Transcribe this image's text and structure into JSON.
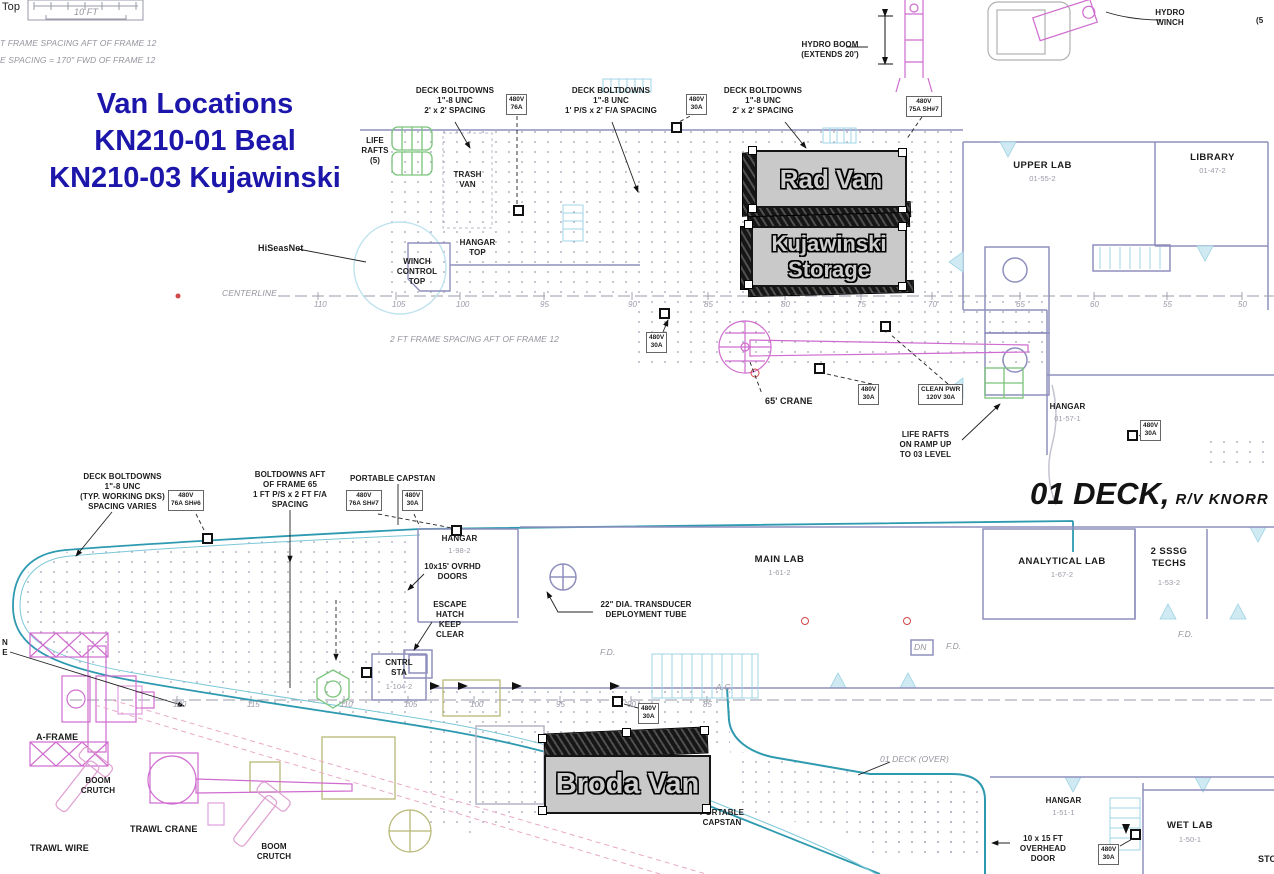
{
  "title": {
    "lines": [
      "Van Locations",
      "KN210-01 Beal",
      "KN210-03 Kujawinski"
    ],
    "color": "#1c16aa"
  },
  "deck_title": {
    "main": "01 DECK,",
    "sub": "R/V KNORR"
  },
  "vans": {
    "rad": "Rad Van",
    "kujawinski": "Kujawinski\nStorage",
    "broda": "Broda Van"
  },
  "colors": {
    "title_blue": "#1c16aa",
    "wall_slate": "#8f8fbe",
    "hull_teal": "#2e9ab0",
    "crane_magenta": "#cf6ccf",
    "raft_green": "#7ac47a",
    "van_gray": "#c9c9c9"
  },
  "annotations": [
    {
      "t": "Top",
      "x": 2,
      "y": 1,
      "c": "med",
      "n": "corner-label-top"
    },
    {
      "t": "10 FT",
      "x": 56,
      "y": 7,
      "w": 60,
      "c": "ic",
      "n": "scale-bar-label"
    },
    {
      "t": "T FRAME SPACING AFT OF FRAME 12",
      "x": 0,
      "y": 38,
      "c": "i",
      "n": "frame-spacing-note-1"
    },
    {
      "t": "E SPACING = 170\" FWD OF FRAME 12",
      "x": 0,
      "y": 55,
      "c": "i",
      "n": "frame-spacing-note-2"
    },
    {
      "t": "DECK BOLTDOWNS\n1\"-8 UNC\n2' x 2' SPACING",
      "x": 405,
      "y": 86,
      "w": 100,
      "c": "c",
      "n": "label-deck-boltdowns-a"
    },
    {
      "t": "DECK BOLTDOWNS\n1\"-8 UNC\n1' P/S x 2' F/A SPACING",
      "x": 550,
      "y": 86,
      "w": 122,
      "c": "c",
      "n": "label-deck-boltdowns-b"
    },
    {
      "t": "DECK BOLTDOWNS\n1\"-8 UNC\n2' x 2' SPACING",
      "x": 713,
      "y": 86,
      "w": 100,
      "c": "c",
      "n": "label-deck-boltdowns-c"
    },
    {
      "t": "HYDRO BOOM\n(EXTENDS 20')",
      "x": 790,
      "y": 40,
      "w": 80,
      "c": "c",
      "n": "label-hydro-boom"
    },
    {
      "t": "HYDRO\nWINCH",
      "x": 1145,
      "y": 8,
      "w": 50,
      "c": "c",
      "n": "label-hydro-winch"
    },
    {
      "t": "(5",
      "x": 1256,
      "y": 16,
      "n": "cut-label-right"
    },
    {
      "t": "LIFE\nRAFTS\n(5)",
      "x": 355,
      "y": 136,
      "w": 40,
      "c": "c",
      "n": "label-life-rafts"
    },
    {
      "t": "TRASH\nVAN",
      "x": 445,
      "y": 170,
      "w": 45,
      "c": "c",
      "n": "label-trash-van"
    },
    {
      "t": "HANGAR\nTOP",
      "x": 450,
      "y": 238,
      "w": 55,
      "c": "c",
      "n": "label-hangar-top"
    },
    {
      "t": "WINCH\nCONTROL\nTOP",
      "x": 392,
      "y": 257,
      "w": 50,
      "c": "c",
      "n": "label-winch-control-top"
    },
    {
      "t": "HiSeasNet",
      "x": 258,
      "y": 243,
      "c": "bold",
      "n": "label-hiseasnet"
    },
    {
      "t": "CENTERLINE",
      "x": 222,
      "y": 288,
      "c": "i",
      "n": "label-centerline"
    },
    {
      "t": "2 FT FRAME SPACING AFT OF FRAME 12",
      "x": 390,
      "y": 334,
      "c": "i",
      "n": "label-frame-spacing-upper"
    },
    {
      "t": "65' CRANE",
      "x": 765,
      "y": 396,
      "c": "bold",
      "n": "label-65ft-crane"
    },
    {
      "t": "LIFE RAFTS\nON RAMP UP\nTO 03 LEVEL",
      "x": 888,
      "y": 430,
      "w": 75,
      "c": "c",
      "n": "label-life-rafts-ramp"
    },
    {
      "t": "HANGAR",
      "x": 1040,
      "y": 402,
      "w": 55,
      "c": "c",
      "n": "label-hangar-0157"
    },
    {
      "t": "01-57-1",
      "x": 1040,
      "y": 414,
      "w": 55,
      "c": "csub"
    },
    {
      "t": "UPPER LAB",
      "x": 1005,
      "y": 160,
      "w": 75,
      "c": "cb",
      "n": "label-upper-lab"
    },
    {
      "t": "01-55-2",
      "x": 1005,
      "y": 174,
      "w": 75,
      "c": "csub"
    },
    {
      "t": "LIBRARY",
      "x": 1185,
      "y": 152,
      "w": 55,
      "c": "cb",
      "n": "label-library"
    },
    {
      "t": "01-47-2",
      "x": 1185,
      "y": 166,
      "w": 55,
      "c": "csub"
    },
    {
      "t": "DECK BOLTDOWNS\n1\"-8 UNC\n(TYP. WORKING DKS)\nSPACING VARIES",
      "x": 70,
      "y": 472,
      "w": 105,
      "c": "c",
      "n": "label-deck-boltdowns-lower"
    },
    {
      "t": "BOLTDOWNS AFT\nOF FRAME 65\n1 FT  P/S x 2 FT F/A\nSPACING",
      "x": 235,
      "y": 470,
      "w": 110,
      "c": "c",
      "n": "label-boltdowns-aft"
    },
    {
      "t": "PORTABLE CAPSTAN",
      "x": 350,
      "y": 474,
      "n": "label-portable-capstan-top"
    },
    {
      "t": "HANGAR",
      "x": 432,
      "y": 534,
      "w": 55,
      "c": "c",
      "n": "label-hangar-1982"
    },
    {
      "t": "1-98-2",
      "x": 432,
      "y": 546,
      "w": 55,
      "c": "csub"
    },
    {
      "t": "10x15' OVRHD\nDOORS",
      "x": 415,
      "y": 562,
      "w": 75,
      "c": "c",
      "n": "label-ovrhd-doors"
    },
    {
      "t": "ESCAPE\nHATCH\nKEEP\nCLEAR",
      "x": 425,
      "y": 600,
      "w": 50,
      "c": "c",
      "n": "label-escape-hatch"
    },
    {
      "t": "CNTRL\nSTA",
      "x": 378,
      "y": 658,
      "w": 42,
      "c": "c",
      "n": "label-cntrl-sta"
    },
    {
      "t": "1-104-2",
      "x": 376,
      "y": 682,
      "w": 46,
      "c": "csub"
    },
    {
      "t": "22\" DIA. TRANSDUCER\nDEPLOYMENT TUBE",
      "x": 592,
      "y": 600,
      "w": 108,
      "c": "c",
      "n": "label-transducer-tube"
    },
    {
      "t": "MAIN LAB",
      "x": 742,
      "y": 554,
      "w": 75,
      "c": "cb",
      "n": "label-main-lab"
    },
    {
      "t": "1-61-2",
      "x": 742,
      "y": 568,
      "w": 75,
      "c": "csub"
    },
    {
      "t": "ANALYTICAL LAB",
      "x": 1008,
      "y": 556,
      "w": 108,
      "c": "cb",
      "n": "label-analytical-lab"
    },
    {
      "t": "1-67-2",
      "x": 1008,
      "y": 570,
      "w": 108,
      "c": "csub"
    },
    {
      "t": "2 SSSG\nTECHS",
      "x": 1145,
      "y": 546,
      "w": 48,
      "c": "cb",
      "n": "label-sssg-techs"
    },
    {
      "t": "1-53-2",
      "x": 1145,
      "y": 578,
      "w": 48,
      "c": "csub"
    },
    {
      "t": "A-FRAME",
      "x": 36,
      "y": 732,
      "c": "bold",
      "n": "label-a-frame"
    },
    {
      "t": "BOOM\nCRUTCH",
      "x": 72,
      "y": 776,
      "w": 52,
      "c": "c",
      "n": "label-boom-crutch-1"
    },
    {
      "t": "TRAWL CRANE",
      "x": 130,
      "y": 824,
      "c": "bold",
      "n": "label-trawl-crane"
    },
    {
      "t": "BOOM\nCRUTCH",
      "x": 248,
      "y": 842,
      "w": 52,
      "c": "c",
      "n": "label-boom-crutch-2"
    },
    {
      "t": "PORTABLE\nCAPSTAN",
      "x": 692,
      "y": 808,
      "w": 60,
      "c": "c",
      "n": "label-portable-capstan-bottom"
    },
    {
      "t": "01 DECK (OVER)",
      "x": 880,
      "y": 754,
      "c": "i",
      "n": "label-01-deck-over"
    },
    {
      "t": "HANGAR",
      "x": 1036,
      "y": 796,
      "w": 55,
      "c": "c",
      "n": "label-hangar-1511"
    },
    {
      "t": "1-51-1",
      "x": 1036,
      "y": 808,
      "w": 55,
      "c": "csub"
    },
    {
      "t": "10 x 15 FT\nOVERHEAD\nDOOR",
      "x": 1012,
      "y": 834,
      "w": 62,
      "c": "c",
      "n": "label-overhead-door"
    },
    {
      "t": "WET LAB",
      "x": 1155,
      "y": 820,
      "w": 70,
      "c": "cb",
      "n": "label-wet-lab"
    },
    {
      "t": "1-50-1",
      "x": 1155,
      "y": 835,
      "w": 70,
      "c": "csub"
    },
    {
      "t": "STO",
      "x": 1258,
      "y": 854,
      "c": "bold",
      "n": "cut-label-sto"
    },
    {
      "t": "TRAWL WIRE",
      "x": 30,
      "y": 843,
      "c": "bold",
      "n": "label-trawl-wire"
    },
    {
      "t": "A.C.",
      "x": 716,
      "y": 682,
      "c": "i",
      "n": "label-ac"
    },
    {
      "t": "F.D.",
      "x": 600,
      "y": 647,
      "c": "i"
    },
    {
      "t": "F.D.",
      "x": 946,
      "y": 641,
      "c": "i"
    },
    {
      "t": "F.D.",
      "x": 1178,
      "y": 629,
      "c": "i"
    },
    {
      "t": "DN",
      "x": 914,
      "y": 642,
      "c": "i"
    },
    {
      "t": "N\nE",
      "x": 0,
      "y": 638,
      "w": 10,
      "c": "c",
      "n": "cut-label-left"
    }
  ],
  "power_labels": [
    {
      "t": "480V\n76A",
      "x": 506,
      "y": 94
    },
    {
      "t": "480V\n30A",
      "x": 686,
      "y": 94
    },
    {
      "t": "480V\n75A SH#7",
      "x": 906,
      "y": 96
    },
    {
      "t": "480V\n30A",
      "x": 646,
      "y": 332
    },
    {
      "t": "480V\n30A",
      "x": 858,
      "y": 384
    },
    {
      "t": "CLEAN PWR\n120V 30A",
      "x": 918,
      "y": 384
    },
    {
      "t": "480V\n30A",
      "x": 1140,
      "y": 420
    },
    {
      "t": "480V\n76A SH#6",
      "x": 168,
      "y": 490
    },
    {
      "t": "480V\n76A SH#7",
      "x": 346,
      "y": 490
    },
    {
      "t": "480V\n30A",
      "x": 402,
      "y": 490
    },
    {
      "t": "480V\n30A",
      "x": 638,
      "y": 703
    },
    {
      "t": "480V\n30A",
      "x": 1098,
      "y": 844
    }
  ],
  "frame_numbers": {
    "upper": [
      {
        "v": "110",
        "x": 314
      },
      {
        "v": "105",
        "x": 392
      },
      {
        "v": "100",
        "x": 456
      },
      {
        "v": "95",
        "x": 540
      },
      {
        "v": "90",
        "x": 628
      },
      {
        "v": "85",
        "x": 704
      },
      {
        "v": "80",
        "x": 781
      },
      {
        "v": "75",
        "x": 857
      },
      {
        "v": "70",
        "x": 928
      },
      {
        "v": "65",
        "x": 1016
      },
      {
        "v": "60",
        "x": 1090
      },
      {
        "v": "55",
        "x": 1163
      },
      {
        "v": "50",
        "x": 1238
      }
    ],
    "lower": [
      {
        "v": "120",
        "x": 173
      },
      {
        "v": "115",
        "x": 247
      },
      {
        "v": "110",
        "x": 340
      },
      {
        "v": "105",
        "x": 404
      },
      {
        "v": "100",
        "x": 470
      },
      {
        "v": "95",
        "x": 556
      },
      {
        "v": "90",
        "x": 627
      },
      {
        "v": "85",
        "x": 703
      }
    ]
  }
}
